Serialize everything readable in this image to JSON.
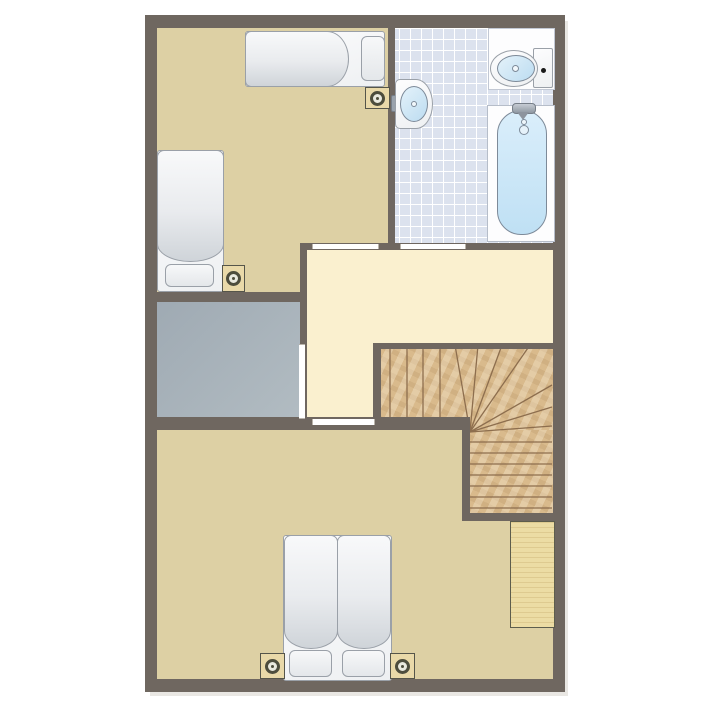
{
  "type": "floor-plan",
  "canvas": {
    "width": 710,
    "height": 710,
    "background": "#ffffff"
  },
  "plan": {
    "x": 145,
    "y": 15,
    "width": 420,
    "height": 677
  },
  "colors": {
    "wall": "#6f6760",
    "bedroom_floor": "#ddd0a4",
    "hall_floor": "#faf0cf",
    "gray_room": "#a9b4bb",
    "tile": "#dce2ee",
    "tile_line": "#ffffff",
    "wood": "#d9ba8c",
    "wood_line": "#8d6e4e",
    "wardrobe": "#ecdca4",
    "furniture_outline": "#9aa0a8",
    "basin_blue": "#cde6f6",
    "nightstand": "#e9d9a9",
    "lamp": "#4d4d3d",
    "door": "#ffffff",
    "flush_button": "#1a1a1a"
  },
  "rooms": [
    {
      "id": "bedroom-top-left",
      "floor": "tan",
      "rects": [
        [
          12,
          13,
          238,
          222
        ],
        [
          12,
          235,
          150,
          52
        ]
      ]
    },
    {
      "id": "bathroom",
      "floor": "tile",
      "rects": [
        [
          243,
          13,
          165,
          222
        ]
      ]
    },
    {
      "id": "hallway",
      "floor": "hall",
      "rects": [
        [
          155,
          228,
          253,
          106
        ],
        [
          155,
          334,
          81,
          81
        ]
      ]
    },
    {
      "id": "gray-room",
      "floor": "gray",
      "rects": [
        [
          12,
          287,
          150,
          128
        ]
      ]
    },
    {
      "id": "bedroom-bottom",
      "floor": "tan",
      "rects": [
        [
          12,
          402,
          396,
          262
        ]
      ]
    }
  ],
  "walls": [
    {
      "id": "exterior-top",
      "rect": [
        0,
        0,
        420,
        13
      ]
    },
    {
      "id": "exterior-left",
      "rect": [
        0,
        0,
        12,
        677
      ]
    },
    {
      "id": "exterior-right",
      "rect": [
        408,
        0,
        12,
        677
      ]
    },
    {
      "id": "exterior-bottom",
      "rect": [
        0,
        664,
        420,
        13
      ]
    },
    {
      "id": "bedroom-bathroom-divider",
      "rect": [
        243,
        13,
        7,
        222
      ]
    },
    {
      "id": "hallway-top",
      "rect": [
        155,
        228,
        253,
        7
      ]
    },
    {
      "id": "hallway-left",
      "rect": [
        155,
        228,
        7,
        187
      ]
    },
    {
      "id": "below-left-bed",
      "rect": [
        0,
        277,
        162,
        10
      ]
    },
    {
      "id": "bedroom-bottom-top",
      "rect": [
        0,
        402,
        325,
        13
      ]
    },
    {
      "id": "stairs-top",
      "rect": [
        228,
        328,
        180,
        6
      ]
    },
    {
      "id": "stairs-left",
      "rect": [
        228,
        328,
        8,
        87
      ]
    },
    {
      "id": "stairs-inner",
      "rect": [
        317,
        415,
        8,
        91
      ]
    },
    {
      "id": "stairs-bottom",
      "rect": [
        317,
        498,
        91,
        8
      ]
    }
  ],
  "doors": [
    {
      "id": "door-bedroom-top",
      "rect": [
        167,
        229,
        65,
        5
      ],
      "orient": "h"
    },
    {
      "id": "door-bathroom",
      "rect": [
        255,
        229,
        64,
        5
      ],
      "orient": "h"
    },
    {
      "id": "door-gray-room",
      "rect": [
        154,
        329,
        6,
        73
      ],
      "orient": "v"
    },
    {
      "id": "door-bedroom-bottom",
      "rect": [
        167,
        404,
        61,
        6
      ],
      "orient": "h"
    }
  ],
  "stairs": {
    "areas": [
      [
        228,
        328,
        180,
        87
      ],
      [
        317,
        415,
        91,
        91
      ]
    ],
    "svg_box": [
      228,
      328,
      180,
      178
    ],
    "winder_center": [
      97,
      89
    ],
    "straight_treads_x": [
      17,
      34,
      50,
      67
    ],
    "straight_tread_y_range": [
      6,
      87
    ],
    "fan_endpoints": [
      [
        82,
        2
      ],
      [
        105,
        2
      ],
      [
        129,
        2
      ],
      [
        157,
        2
      ],
      [
        179,
        42
      ],
      [
        179,
        64
      ],
      [
        179,
        83
      ]
    ],
    "lower_treads_y": [
      99,
      110,
      121,
      132,
      143,
      154,
      165
    ],
    "lower_tread_x_range": [
      97,
      179
    ]
  },
  "furniture": [
    {
      "type": "bed",
      "id": "bed-single-top",
      "dir": "right",
      "base": [
        100,
        16,
        138,
        54
      ],
      "duvets": [
        [
          100,
          16,
          102,
          54
        ]
      ],
      "pillows": [
        [
          216,
          21,
          22,
          43
        ]
      ]
    },
    {
      "type": "nightstand",
      "id": "nightstand-top",
      "rect": [
        220,
        72,
        23,
        20
      ]
    },
    {
      "type": "bed",
      "id": "bed-single-left",
      "dir": "down",
      "base": [
        12,
        135,
        65,
        140
      ],
      "duvets": [
        [
          12,
          135,
          65,
          110
        ]
      ],
      "pillows": [
        [
          20,
          249,
          47,
          21
        ]
      ]
    },
    {
      "type": "nightstand",
      "id": "nightstand-left",
      "rect": [
        77,
        250,
        21,
        25
      ]
    },
    {
      "type": "sink",
      "id": "sink",
      "body": [
        250,
        64,
        36,
        48
      ],
      "basin": [
        255,
        71,
        26,
        34
      ],
      "faucet": [
        246,
        80,
        8,
        15
      ]
    },
    {
      "type": "toilet",
      "id": "toilet",
      "platform": [
        343,
        13,
        65,
        60
      ],
      "cistern": [
        388,
        33,
        18,
        38
      ],
      "bowl": [
        345,
        35,
        46,
        35
      ],
      "basin": [
        352,
        40,
        36,
        25
      ],
      "button": [
        396,
        53,
        5,
        5
      ]
    },
    {
      "type": "bathtub",
      "id": "bathtub",
      "body": [
        342,
        90,
        66,
        135
      ],
      "water": [
        352,
        95,
        48,
        123
      ],
      "faucet": [
        367,
        88,
        22,
        9
      ],
      "spout": [
        372,
        97,
        12,
        8
      ],
      "dot": [
        376,
        104,
        4,
        4
      ],
      "drain": [
        374,
        110,
        8,
        8
      ]
    },
    {
      "type": "wardrobe",
      "id": "wardrobe",
      "rect": [
        365,
        506,
        43,
        105
      ]
    },
    {
      "type": "bed",
      "id": "bed-double",
      "dir": "down",
      "base": [
        138,
        520,
        107,
        144
      ],
      "duvets": [
        [
          139,
          520,
          52,
          112
        ],
        [
          192,
          520,
          52,
          112
        ]
      ],
      "pillows": [
        [
          144,
          635,
          41,
          25
        ],
        [
          197,
          635,
          41,
          25
        ]
      ]
    },
    {
      "type": "nightstand",
      "id": "nightstand-bottom-left",
      "rect": [
        115,
        638,
        23,
        24
      ]
    },
    {
      "type": "nightstand",
      "id": "nightstand-bottom-right",
      "rect": [
        245,
        638,
        23,
        24
      ]
    }
  ]
}
